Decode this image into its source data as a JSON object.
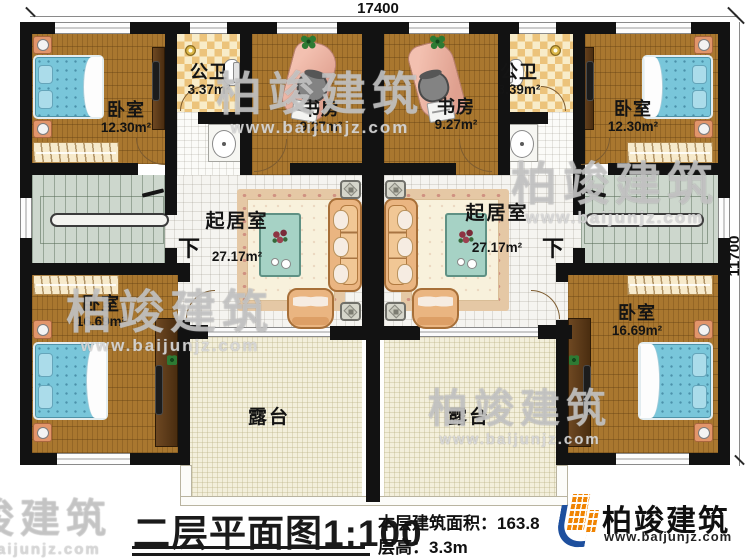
{
  "dimensions": {
    "top": "17400",
    "right": "11700"
  },
  "rooms": {
    "bedroom_tl": {
      "name": "卧室",
      "area": "12.30m²"
    },
    "bath_l": {
      "name": "公卫",
      "area": "3.37m²"
    },
    "study_l": {
      "name": "书房",
      "area": "9.27m²"
    },
    "study_r": {
      "name": "书房",
      "area": "9.27m²"
    },
    "bath_r": {
      "name": "公卫",
      "area": "3.39m²"
    },
    "bedroom_tr": {
      "name": "卧室",
      "area": "12.30m²"
    },
    "living_l": {
      "name": "起居室",
      "area": "27.17m²"
    },
    "living_r": {
      "name": "起居室",
      "area": "27.17m²"
    },
    "bedroom_bl": {
      "name": "卧室",
      "area": "16.69m²"
    },
    "bedroom_br": {
      "name": "卧室",
      "area": "16.69m²"
    },
    "terrace_l": {
      "name": "露台"
    },
    "terrace_r": {
      "name": "露台"
    }
  },
  "stairs": {
    "down": "下"
  },
  "footer": {
    "title": "二层平面图",
    "scale": "1:100",
    "area_text": "本层建筑面积：163.8",
    "height_text": "层高：3.3m"
  },
  "logo": {
    "name": "柏竣建筑",
    "url": "www.baijunjz.com"
  },
  "watermark": {
    "name": "柏竣建筑",
    "url": "www.baijunjz.com"
  },
  "colors": {
    "wall": "#121212",
    "wood": "#a9772f",
    "bed": "#79c6da",
    "logo_orange": "#f08300",
    "logo_blue": "#1d4f9e"
  }
}
